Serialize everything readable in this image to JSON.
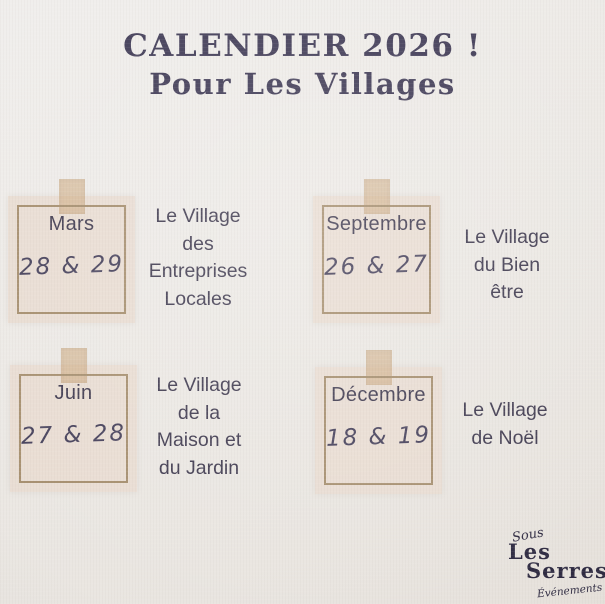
{
  "poster": {
    "title_line1": "CALENDIER 2026 !",
    "title_line2": "Pour Les Villages"
  },
  "events": [
    {
      "month": "Mars",
      "dates": "28 & 29",
      "village": "Le Village\ndes\nEntreprises\nLocales"
    },
    {
      "month": "Septembre",
      "dates": "26 & 27",
      "village": "Le Village\ndu Bien\nêtre"
    },
    {
      "month": "Juin",
      "dates": "27 & 28",
      "village": "Le Village\nde la\nMaison et\ndu Jardin"
    },
    {
      "month": "Décembre",
      "dates": "18 & 19",
      "village": "Le Village\nde Noël"
    }
  ],
  "logo": {
    "prefix": "Sous",
    "name_line1": "Les",
    "name_line2": "Serres",
    "suffix": "Événements"
  },
  "colors": {
    "background": "#ECE9E6",
    "title": "#3E3954",
    "text": "#403B50",
    "card_bg": "#E9DDD3",
    "card_border": "#A68F6F",
    "tape": "#CDA87D"
  }
}
